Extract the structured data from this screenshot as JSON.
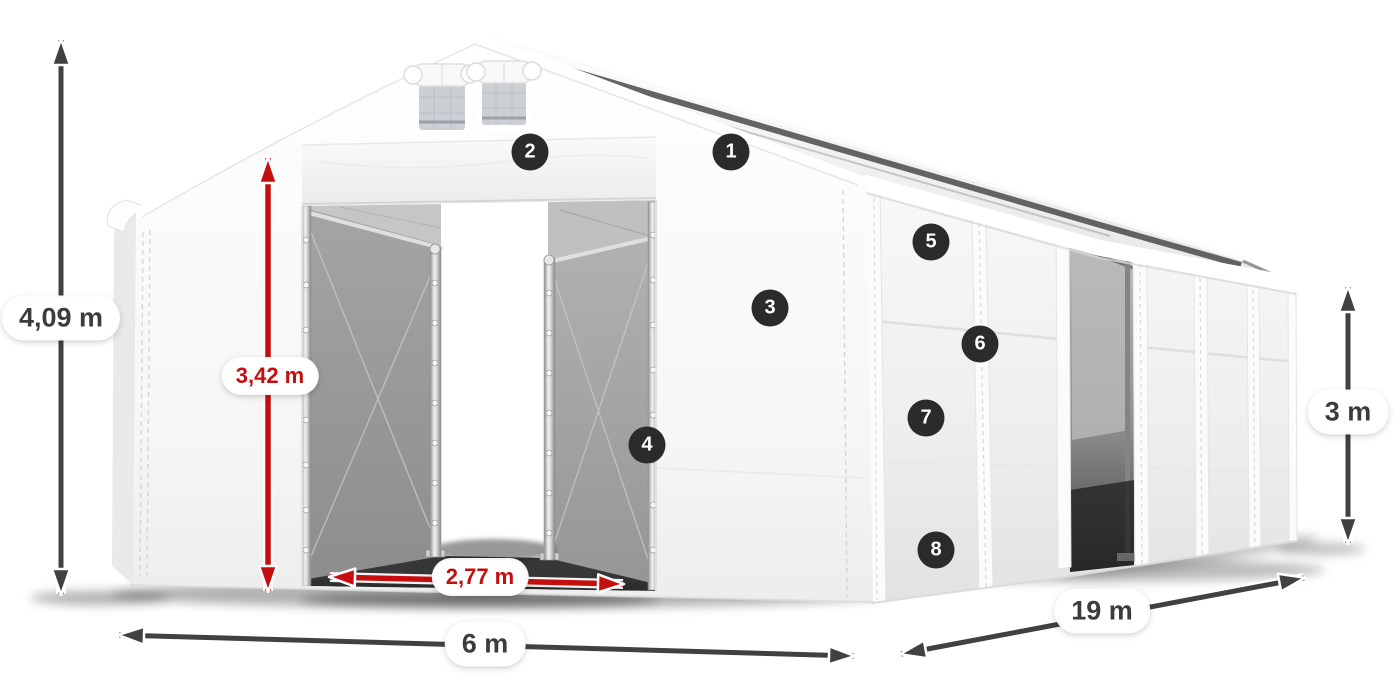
{
  "diagram": {
    "dimensions": {
      "total_height": {
        "value": "4,09 m",
        "style": "dark"
      },
      "entrance_height": {
        "value": "3,42 m",
        "style": "red"
      },
      "entrance_width": {
        "value": "2,77 m",
        "style": "red"
      },
      "span_width": {
        "value": "6 m",
        "style": "dark"
      },
      "length": {
        "value": "19 m",
        "style": "dark"
      },
      "side_height": {
        "value": "3 m",
        "style": "dark"
      }
    },
    "markers": [
      "1",
      "2",
      "3",
      "4",
      "5",
      "6",
      "7",
      "8"
    ],
    "colors": {
      "dimension_red": "#c50f0f",
      "arrow_dark": "#414141",
      "badge_background": "#2b2b2b",
      "label_text": "#3c3c3c"
    }
  }
}
